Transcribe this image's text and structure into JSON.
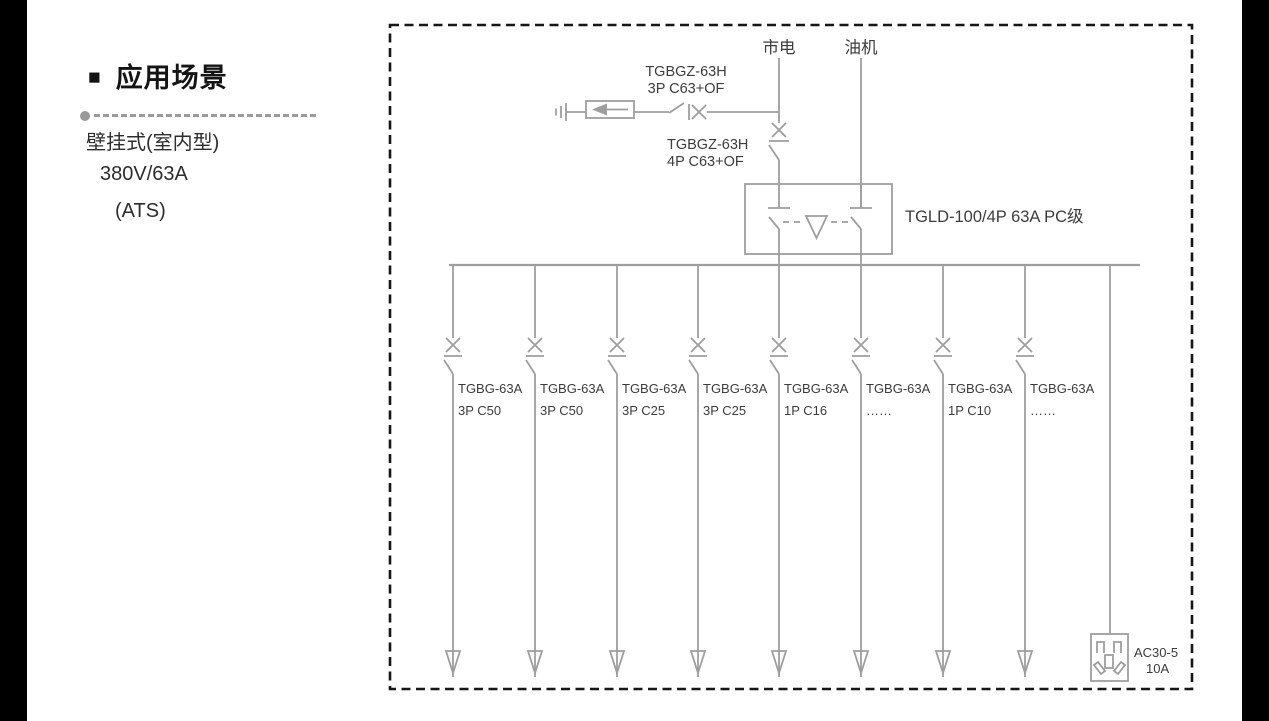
{
  "sidebar": {
    "bullet": "■",
    "title": "应用场景",
    "lines": [
      "壁挂式(室内型)",
      "380V/63A",
      "(ATS)"
    ]
  },
  "diagram": {
    "mains_label": "市电",
    "generator_label": "油机",
    "spd_breaker": {
      "model": "TGBGZ-63H",
      "spec": "3P C63+OF"
    },
    "main_breaker": {
      "model": "TGBGZ-63H",
      "spec": "4P C63+OF"
    },
    "ats_label": "TGLD-100/4P 63A PC级",
    "feeders": [
      {
        "model": "TGBG-63A",
        "spec": "3P C50"
      },
      {
        "model": "TGBG-63A",
        "spec": "3P C50"
      },
      {
        "model": "TGBG-63A",
        "spec": "3P C25"
      },
      {
        "model": "TGBG-63A",
        "spec": "3P C25"
      },
      {
        "model": "TGBG-63A",
        "spec": "1P C16"
      },
      {
        "model": "TGBG-63A",
        "spec": "……"
      },
      {
        "model": "TGBG-63A",
        "spec": "1P C10"
      },
      {
        "model": "TGBG-63A",
        "spec": "……"
      }
    ],
    "socket": {
      "model": "AC30-5",
      "spec": "10A"
    },
    "colors": {
      "line": "#9e9e9e",
      "border": "#161616",
      "text": "#3c3c3c"
    }
  }
}
